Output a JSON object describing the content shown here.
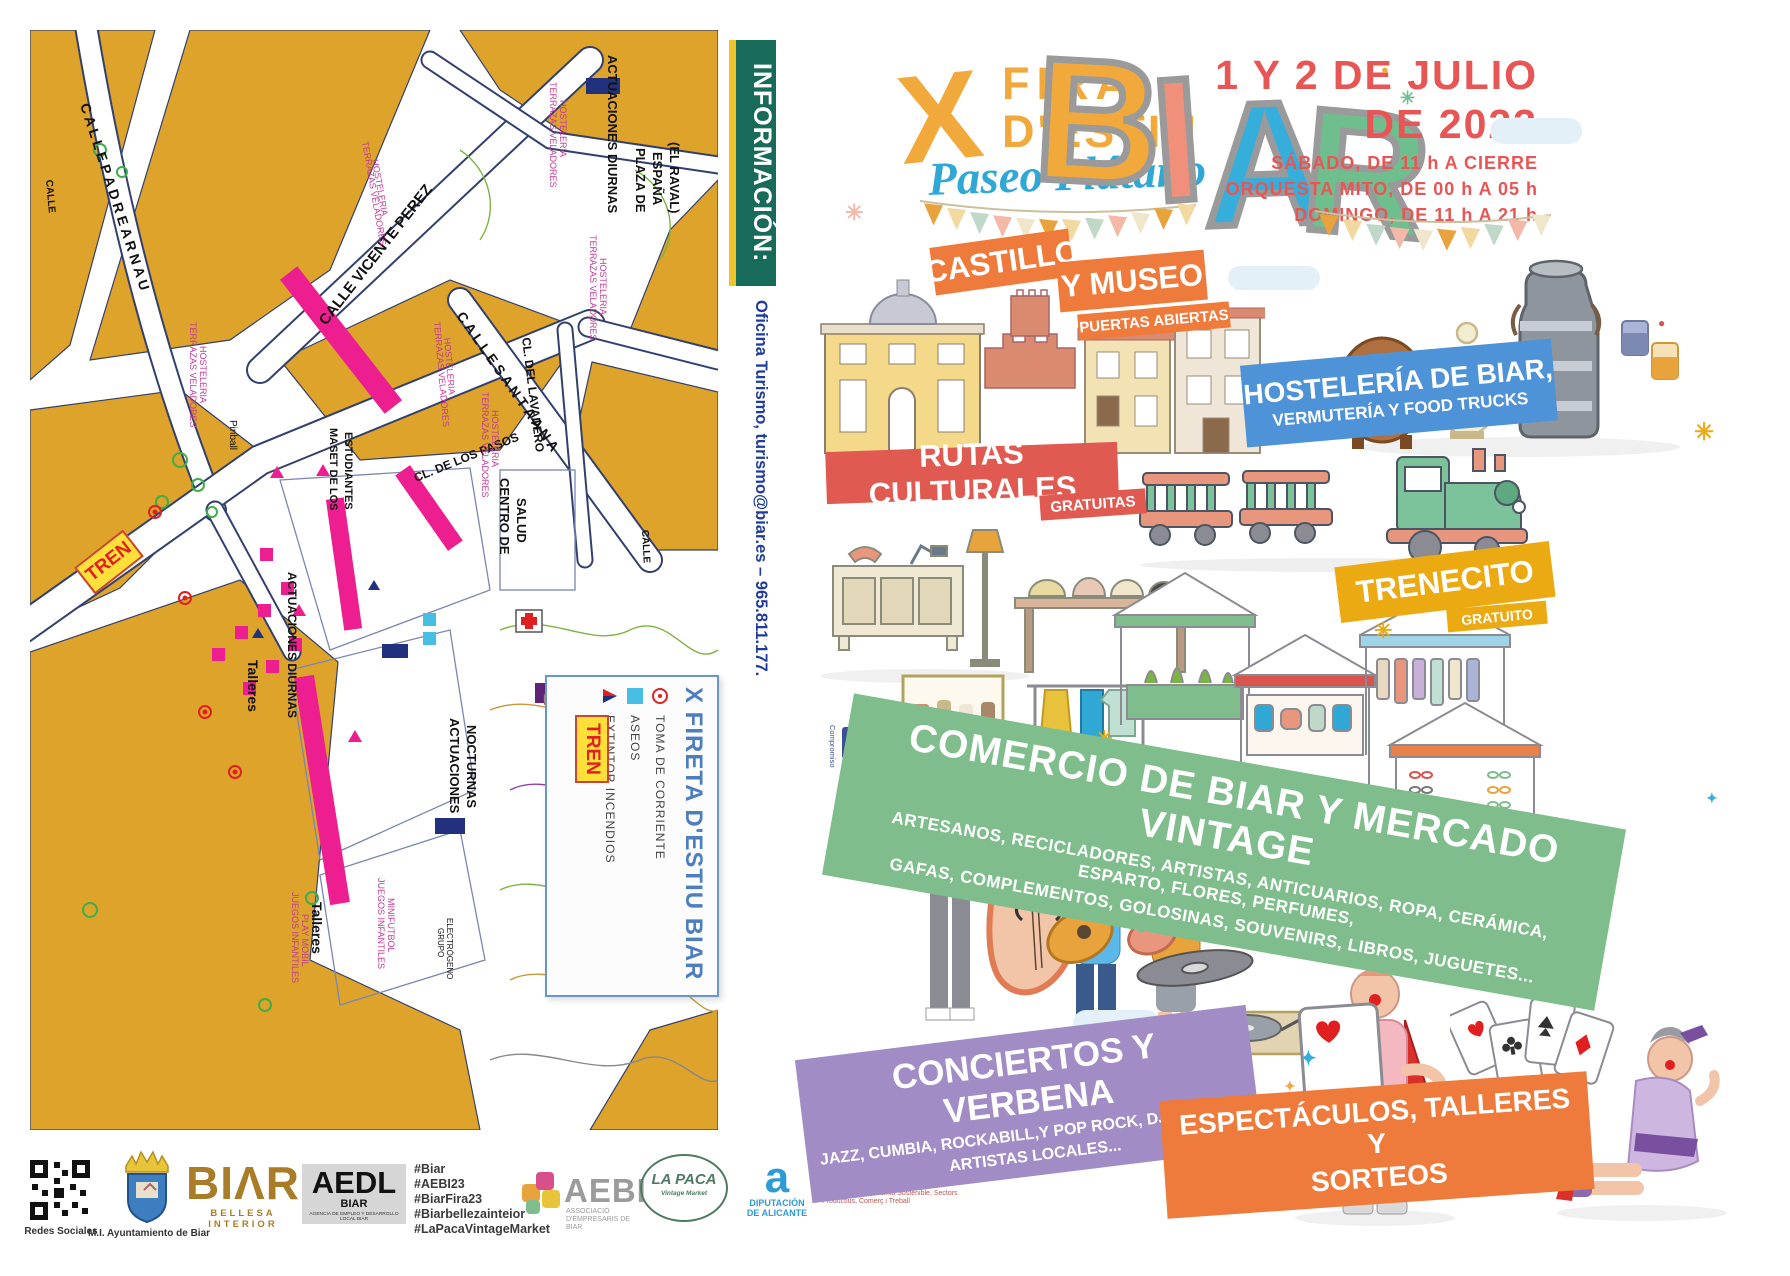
{
  "left": {
    "info_bar": "INFORMACIÓN:",
    "contact": "Oficina Turismo, turismo@biar.es  –  965.811.177.",
    "quality_logo": {
      "line1": "Compromiso",
      "line2": "#CalidadTurística",
      "mark": "CT"
    },
    "map": {
      "tren_label": "TREN",
      "legend": {
        "title": "X FIRETA D'ESTIU BIAR",
        "items": [
          {
            "icon": "power-outlet-icon",
            "label": "TOMA DE CORRIENTE"
          },
          {
            "icon": "toilets-icon",
            "label": "ASEOS"
          },
          {
            "icon": "fire-extinguisher-icon",
            "label": "EXTINTOR INCENDIOS"
          }
        ]
      },
      "labels": [
        {
          "t": "C A L L E   P A D R E   A R N A U",
          "x": 50,
          "y": 75,
          "r": 72,
          "s": 14,
          "b": 1
        },
        {
          "t": "CALLE",
          "x": 16,
          "y": 150,
          "r": 85,
          "s": 10,
          "b": 1
        },
        {
          "t": "CALLE VICENTE PEREZ",
          "x": 296,
          "y": 296,
          "r": -52,
          "s": 15,
          "b": 1
        },
        {
          "t": "C A L L E   S A N T A   A N A",
          "x": 426,
          "y": 286,
          "r": 55,
          "s": 14,
          "b": 1
        },
        {
          "t": "CL.  DEL  LAVADERO",
          "x": 492,
          "y": 308,
          "r": 83,
          "s": 12,
          "b": 1
        },
        {
          "t": "CL. DE LOS PASOS",
          "x": 386,
          "y": 452,
          "r": -22,
          "s": 12,
          "b": 1
        },
        {
          "t": "CALLE",
          "x": 612,
          "y": 500,
          "r": 87,
          "s": 10,
          "b": 1
        },
        {
          "t": "ACTUACIONES DIURNAS",
          "x": 578,
          "y": 25,
          "r": 90,
          "s": 13,
          "b": 1
        },
        {
          "t": "PLAZA DE",
          "x": 606,
          "y": 118,
          "r": 90,
          "s": 13,
          "b": 1
        },
        {
          "t": "ESPAÑA",
          "x": 623,
          "y": 122,
          "r": 90,
          "s": 13,
          "b": 1
        },
        {
          "t": "(EL RAVAL)",
          "x": 640,
          "y": 112,
          "r": 90,
          "s": 13,
          "b": 1
        },
        {
          "t": "MASET DE LOS",
          "x": 300,
          "y": 398,
          "r": 90,
          "s": 11,
          "b": 1
        },
        {
          "t": "ESTUDIANTES",
          "x": 315,
          "y": 402,
          "r": 90,
          "s": 11,
          "b": 1
        },
        {
          "t": "CENTRO DE",
          "x": 470,
          "y": 448,
          "r": 90,
          "s": 13,
          "b": 1
        },
        {
          "t": "SALUD",
          "x": 487,
          "y": 468,
          "r": 90,
          "s": 13,
          "b": 1
        },
        {
          "t": "ACTUACIONES DIURNAS",
          "x": 258,
          "y": 542,
          "r": 90,
          "s": 12,
          "b": 1
        },
        {
          "t": "ACTUACIONES",
          "x": 420,
          "y": 688,
          "r": 90,
          "s": 13,
          "b": 1
        },
        {
          "t": "NOCTURNAS",
          "x": 437,
          "y": 695,
          "r": 90,
          "s": 13,
          "b": 1
        },
        {
          "t": "Talleres",
          "x": 218,
          "y": 630,
          "r": 90,
          "s": 14,
          "b": 1
        },
        {
          "t": "Talleres",
          "x": 282,
          "y": 872,
          "r": 90,
          "s": 14,
          "b": 1
        },
        {
          "t": "Pinball",
          "x": 200,
          "y": 390,
          "r": 90,
          "s": 10
        },
        {
          "t": "TERRAZAS VELADORES",
          "x": 160,
          "y": 292,
          "r": 90,
          "s": 9,
          "c": "#c23a96"
        },
        {
          "t": "HOSTELERIA",
          "x": 170,
          "y": 316,
          "r": 90,
          "s": 9,
          "c": "#c23a96"
        },
        {
          "t": "TERRAZAS VELADORES",
          "x": 332,
          "y": 112,
          "r": 80,
          "s": 9,
          "c": "#c23a96"
        },
        {
          "t": "HOSTELERIA",
          "x": 342,
          "y": 130,
          "r": 80,
          "s": 9,
          "c": "#c23a96"
        },
        {
          "t": "TERRAZAS VELADORES",
          "x": 520,
          "y": 52,
          "r": 90,
          "s": 9,
          "c": "#c23a96"
        },
        {
          "t": "HOSTELERIA",
          "x": 530,
          "y": 70,
          "r": 90,
          "s": 9,
          "c": "#c23a96"
        },
        {
          "t": "TERRAZAS VELADORES",
          "x": 560,
          "y": 205,
          "r": 90,
          "s": 9,
          "c": "#c23a96"
        },
        {
          "t": "HOSTELERIA",
          "x": 570,
          "y": 228,
          "r": 90,
          "s": 9,
          "c": "#c23a96"
        },
        {
          "t": "TERRAZAS VELADORES",
          "x": 404,
          "y": 292,
          "r": 85,
          "s": 9,
          "c": "#c23a96"
        },
        {
          "t": "HOSTELERIA",
          "x": 414,
          "y": 308,
          "r": 85,
          "s": 9,
          "c": "#c23a96"
        },
        {
          "t": "TERRAZAS VELADORES",
          "x": 452,
          "y": 362,
          "r": 90,
          "s": 9,
          "c": "#c23a96"
        },
        {
          "t": "HOSTELERIA",
          "x": 462,
          "y": 380,
          "r": 90,
          "s": 9,
          "c": "#c23a96"
        },
        {
          "t": "JUEGOS INFANTILES",
          "x": 262,
          "y": 862,
          "r": 90,
          "s": 9,
          "c": "#c23a96"
        },
        {
          "t": "PLAY MOBIL",
          "x": 272,
          "y": 884,
          "r": 90,
          "s": 9,
          "c": "#c23a96"
        },
        {
          "t": "JUEGOS INFANTILES",
          "x": 348,
          "y": 848,
          "r": 90,
          "s": 9,
          "c": "#c23a96"
        },
        {
          "t": "MINIFUTBOL",
          "x": 358,
          "y": 868,
          "r": 90,
          "s": 9,
          "c": "#c23a96"
        },
        {
          "t": "GRUPO",
          "x": 408,
          "y": 898,
          "r": 90,
          "s": 8
        },
        {
          "t": "ELECTRÓGENO",
          "x": 417,
          "y": 888,
          "r": 90,
          "s": 8
        }
      ]
    }
  },
  "right": {
    "title": {
      "x": "X",
      "line1": "FIRA",
      "line2": "D'ESTIU",
      "subtitle": "Paseo Plátano",
      "biar": {
        "b": "B",
        "i": "I",
        "a": "A",
        "r": "R"
      }
    },
    "date": {
      "line1": "1 Y 2 DE JULIO",
      "line2": "DE 2023",
      "sched1": "SÁBADO, DE 11 h A CIERRE",
      "sched2": "ORQUESTA MITO, DE 00 h A 05 h",
      "sched3": "DOMINGO, DE 11 h A 21 h"
    },
    "badges": {
      "castillo": {
        "l1": "CASTILLO",
        "l2": "Y MUSEO",
        "l3": "PUERTAS ABIERTAS"
      },
      "hosteleria": {
        "l1": "HOSTELERÍA DE BIAR,",
        "l2": "VERMUTERÍA Y FOOD TRUCKS"
      },
      "rutas": {
        "l1": "RUTAS CULTURALES",
        "l2": "GRATUITAS"
      },
      "trenecito": {
        "l1": "TRENECITO",
        "l2": "GRATUITO"
      },
      "comercio": {
        "l1": "COMERCIO DE BIAR Y MERCADO VINTAGE",
        "sub1": "ARTESANOS, RECICLADORES, ARTISTAS, ANTICUARIOS, ROPA, CERÁMICA, ESPARTO, FLORES, PERFUMES,",
        "sub2": "GAFAS, COMPLEMENTOS, GOLOSINAS, SOUVENIRS, LIBROS, JUGUETES..."
      },
      "conciertos": {
        "l1": "CONCIERTOS Y VERBENA",
        "sub1": "JAZZ, CUMBIA, ROCKABILL,Y POP ROCK, DJ VINTAGE,",
        "sub2": "ARTISTAS LOCALES..."
      },
      "espectaculos": {
        "l1": "ESPECTÁCULOS, TALLERES Y",
        "l2": "SORTEOS"
      }
    }
  },
  "footer": {
    "qr_caption": "Redes Sociales",
    "ayuntamiento_caption": "M.I. Ayuntamiento de Biar",
    "biar_logo": {
      "wordmark": "BIΛR",
      "subtitle": "BELLESA INTERIOR"
    },
    "aedl": {
      "title": "AEDL",
      "subtitle": "BIAR",
      "caption": "AGENCIA DE EMPLEO Y DESARROLLO LOCAL BIAR"
    },
    "hashtags": [
      "#Biar",
      "#AEBI23",
      "#BiarFira23",
      "#Biarbellezainteior",
      "#LaPacaVintageMarket"
    ],
    "aebi": {
      "title": "AEBI",
      "subtitle": "ASSOCIACIÓ D'EMPRESARIS DE BIAR"
    },
    "lapaca": {
      "title": "LA PACA",
      "subtitle": "Vintage Market"
    },
    "diputacion": {
      "mark": "a",
      "title": "DIPUTACIÓN DE ALICANTE"
    },
    "generalitat": {
      "title": "GENERALITAT VALENCIANA",
      "subtitle": "Conselleria d'Economia Sostenible, Sectors Productius, Comerç i Treball"
    }
  },
  "decor": {
    "flag_colors": [
      "#e8a33d",
      "#f2d9a0",
      "#bfd8c7",
      "#f3b8a8",
      "#efe6cc"
    ]
  },
  "colors": {
    "map_block": "#dda32a",
    "map_outline": "#33406e",
    "stall_pink": "#ed1e8f",
    "orange_band": "#ee7b3c",
    "red_band": "#e05a52",
    "blue_band": "#4e92d8",
    "green_band": "#7fbe8c",
    "purple_band": "#a18cc6",
    "yellow_band": "#eba912",
    "date_red": "#e85555",
    "info_green": "#176b58",
    "biar_b": "#f2a93b",
    "biar_i": "#f0907b",
    "biar_a": "#35aedc",
    "biar_r": "#6fbf8e"
  }
}
